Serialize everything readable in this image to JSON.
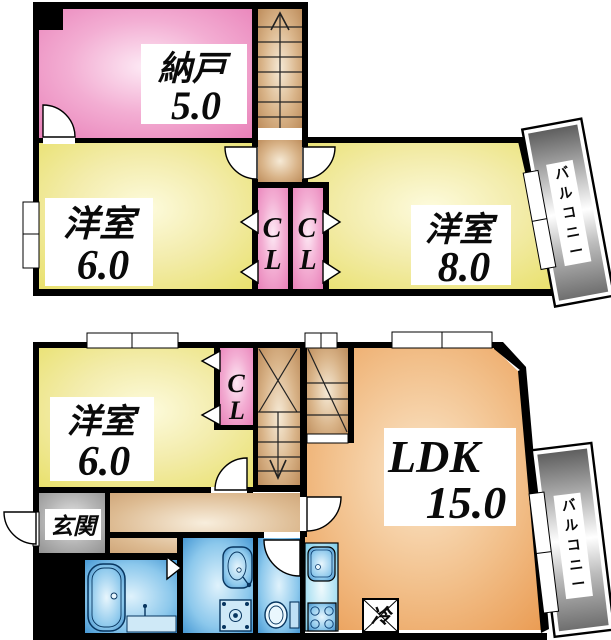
{
  "plan_title": "2-story apartment floor plan",
  "colors": {
    "wall": "#000000",
    "room_pink": "#e779b4",
    "room_yellow": "#e7df63",
    "room_orange": "#e9964a",
    "stairs_brown": "#b5814e",
    "entrance_gray": "#8c8c8c",
    "wet_area_blue": "#2f88cc",
    "balcony_gray": "#6f6f6f"
  },
  "upper_floor": {
    "storage": {
      "label": "納戸",
      "size": "5.0"
    },
    "west_room_6": {
      "label": "洋室",
      "size": "6.0"
    },
    "west_room_8": {
      "label": "洋室",
      "size": "8.0"
    },
    "closet_left": {
      "line1": "C",
      "line2": "L"
    },
    "closet_right": {
      "line1": "C",
      "line2": "L"
    },
    "balcony": {
      "chars": [
        "バ",
        "ル",
        "コ",
        "ニ",
        "ー"
      ]
    },
    "stairs_direction": "up"
  },
  "lower_floor": {
    "west_room_6": {
      "label": "洋室",
      "size": "6.0"
    },
    "closet": {
      "line1": "C",
      "line2": "L"
    },
    "ldk": {
      "label": "LDK",
      "size": "15.0"
    },
    "entrance": {
      "label": "玄関"
    },
    "refrigerator": {
      "label": "冷"
    },
    "balcony": {
      "chars": [
        "バ",
        "ル",
        "コ",
        "ニ",
        "ー"
      ]
    },
    "stairs_direction": "down"
  }
}
